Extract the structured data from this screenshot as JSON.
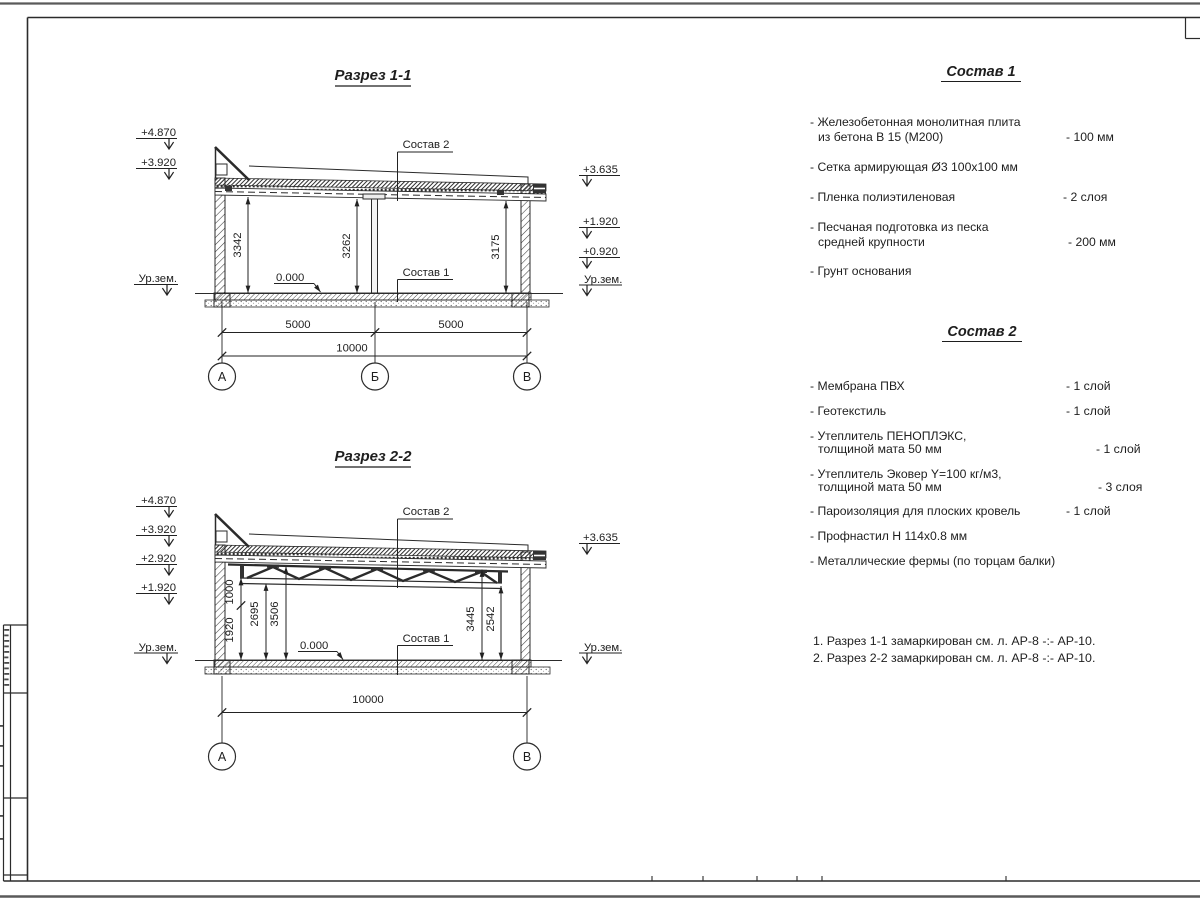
{
  "section1": {
    "title": "Разрез 1-1",
    "levels_left": [
      "+4.870",
      "+3.920",
      "Ур.зем."
    ],
    "levels_right": [
      "+3.635",
      "+1.920",
      "+0.920",
      "Ур.зем."
    ],
    "heights": [
      "3342",
      "3262",
      "3175"
    ],
    "zero": "0.000",
    "callout_roof": "Состав 2",
    "callout_floor": "Состав 1",
    "dims": [
      "5000",
      "5000"
    ],
    "dim_total": "10000",
    "axes": [
      "А",
      "Б",
      "В"
    ]
  },
  "section2": {
    "title": "Разрез 2-2",
    "levels_left": [
      "+4.870",
      "+3.920",
      "+2.920",
      "+1.920",
      "Ур.зем."
    ],
    "levels_right": [
      "+3.635",
      "Ур.зем."
    ],
    "heights_left": [
      "1000",
      "1920",
      "2695",
      "3506"
    ],
    "heights_right": [
      "3445",
      "2542"
    ],
    "zero": "0.000",
    "callout_roof": "Состав 2",
    "callout_floor": "Состав 1",
    "dim_total": "10000",
    "axes": [
      "А",
      "В"
    ]
  },
  "composition1": {
    "title": "Состав 1",
    "items": [
      {
        "l1": "- Железобетонная монолитная плита",
        "l2": "из бетона В 15 (М200)",
        "v": "- 100 мм"
      },
      {
        "l1": "- Сетка армирующая Ø3 100х100 мм",
        "v": ""
      },
      {
        "l1": "- Пленка полиэтиленовая",
        "v": "- 2 слоя"
      },
      {
        "l1": "- Песчаная подготовка из песка",
        "l2": "средней крупности",
        "v": "- 200 мм"
      },
      {
        "l1": "- Грунт основания",
        "v": ""
      }
    ]
  },
  "composition2": {
    "title": "Состав 2",
    "items": [
      {
        "l1": "- Мембрана ПВХ",
        "v": "- 1 слой"
      },
      {
        "l1": "- Геотекстиль",
        "v": "- 1 слой"
      },
      {
        "l1": "- Утеплитель ПЕНОПЛЭКС,",
        "l2": "толщиной мата 50 мм",
        "v": "- 1 слой"
      },
      {
        "l1": "- Утеплитель Эковер Y=100 кг/м3,",
        "l2": "толщиной мата 50 мм",
        "v": "- 3 слоя"
      },
      {
        "l1": "- Пароизоляция для плоских кровель",
        "v": "- 1 слой"
      },
      {
        "l1": "- Профнастил Н 114х0.8 мм",
        "v": ""
      },
      {
        "l1": "- Металлические фермы (по торцам балки)",
        "v": ""
      }
    ]
  },
  "notes": {
    "lines": [
      "1. Разрез 1-1 замаркирован см. л. АР-8 -:- АР-10.",
      "2. Разрез 2-2 замаркирован см. л. АР-8 -:- АР-10."
    ]
  },
  "colors": {
    "line": "#2b2b2b",
    "text": "#1e1e1e",
    "paper": "#ffffff"
  }
}
